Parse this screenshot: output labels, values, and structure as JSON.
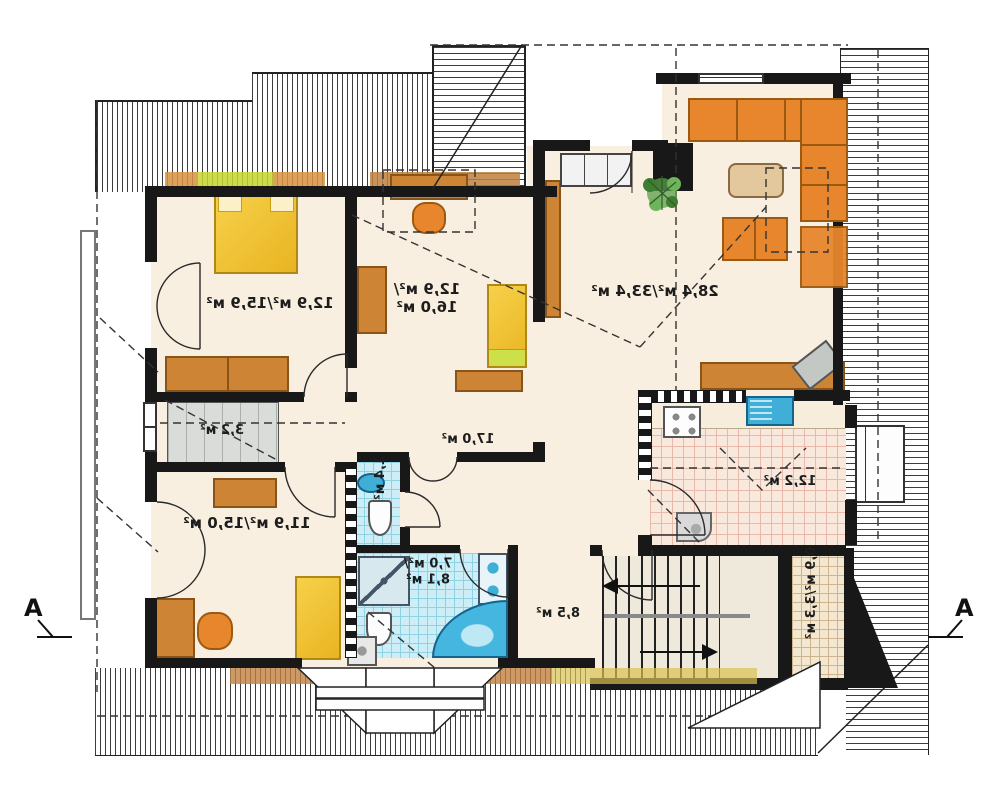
{
  "plan": {
    "section_marker_left": "A",
    "section_marker_right": "A",
    "rooms": [
      {
        "id": "bedroom-top-left",
        "area_label": "12,9 м²/15,9 м²"
      },
      {
        "id": "bedroom-middle",
        "lines": [
          "12,9 м²/",
          "16,0 м²"
        ]
      },
      {
        "id": "living-room",
        "area_label": "28,4 м²/33,4 м²"
      },
      {
        "id": "hall",
        "area_label": "17,0 м²"
      },
      {
        "id": "wardrobe",
        "area_label": "3,2 м²"
      },
      {
        "id": "bedroom-lower-left",
        "area_label": "11,9 м²/15,0 м²"
      },
      {
        "id": "wc",
        "area_label": "1,4 м²"
      },
      {
        "id": "bathroom",
        "lines": [
          "7,0 м²/",
          "8,1 м²"
        ]
      },
      {
        "id": "stair-room",
        "area_label": "8,5 м²"
      },
      {
        "id": "kitchen",
        "area_label": "12,2 м²"
      },
      {
        "id": "pantry",
        "area_label": "0,9 м²/3,3 м²"
      }
    ],
    "colors": {
      "wall": "#181818",
      "floor": "#f9efe0",
      "furniture_orange": "#e8862e",
      "furniture_brown": "#cd8434",
      "bed_yellow": "#f2c230",
      "tile_blue": "#cdeef7",
      "fixture_blue": "#3fafd8",
      "kitchen_tile": "#f9e9dd",
      "accent_green": "#c3d62e",
      "plant_green": "#5a9e4a"
    }
  }
}
